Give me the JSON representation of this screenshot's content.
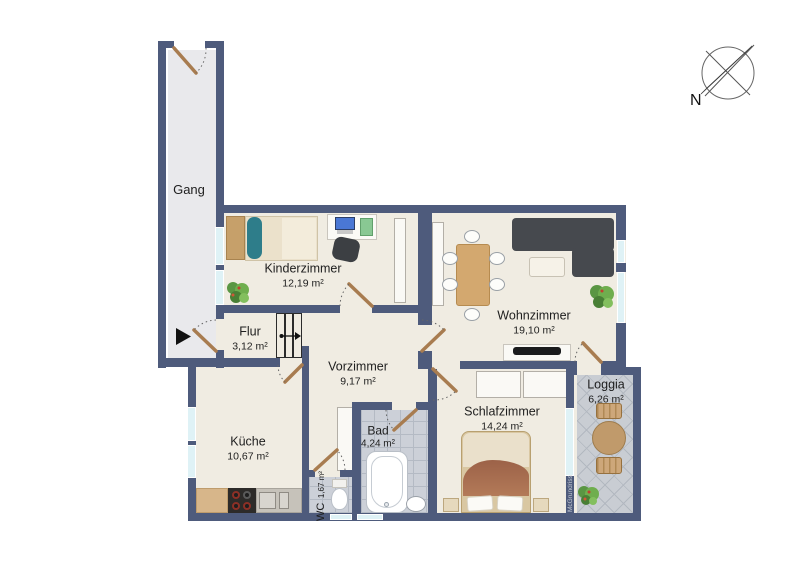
{
  "plan": {
    "compass_label": "N",
    "watermark": "McGrundriss",
    "rooms": {
      "gang": {
        "name": "Gang"
      },
      "kinderzimmer": {
        "name": "Kinderzimmer",
        "area": "12,19 m²"
      },
      "flur": {
        "name": "Flur",
        "area": "3,12 m²"
      },
      "vorzimmer": {
        "name": "Vorzimmer",
        "area": "9,17 m²"
      },
      "wohnzimmer": {
        "name": "Wohnzimmer",
        "area": "19,10 m²"
      },
      "kueche": {
        "name": "Küche",
        "area": "10,67 m²"
      },
      "wc": {
        "name": "WC",
        "area": "1,67 m²"
      },
      "bad": {
        "name": "Bad",
        "area": "4,24 m²"
      },
      "schlafzimmer": {
        "name": "Schlafzimmer",
        "area": "14,24 m²"
      },
      "loggia": {
        "name": "Loggia",
        "area": "6,26 m²"
      }
    },
    "colors": {
      "wall": "#4e5b7c",
      "floor": "#f0ece2",
      "gang-floor": "#e9e9ec",
      "tile-floor": "#ccd0d8",
      "window": "#dff2f6",
      "door": "#a87c50"
    }
  }
}
